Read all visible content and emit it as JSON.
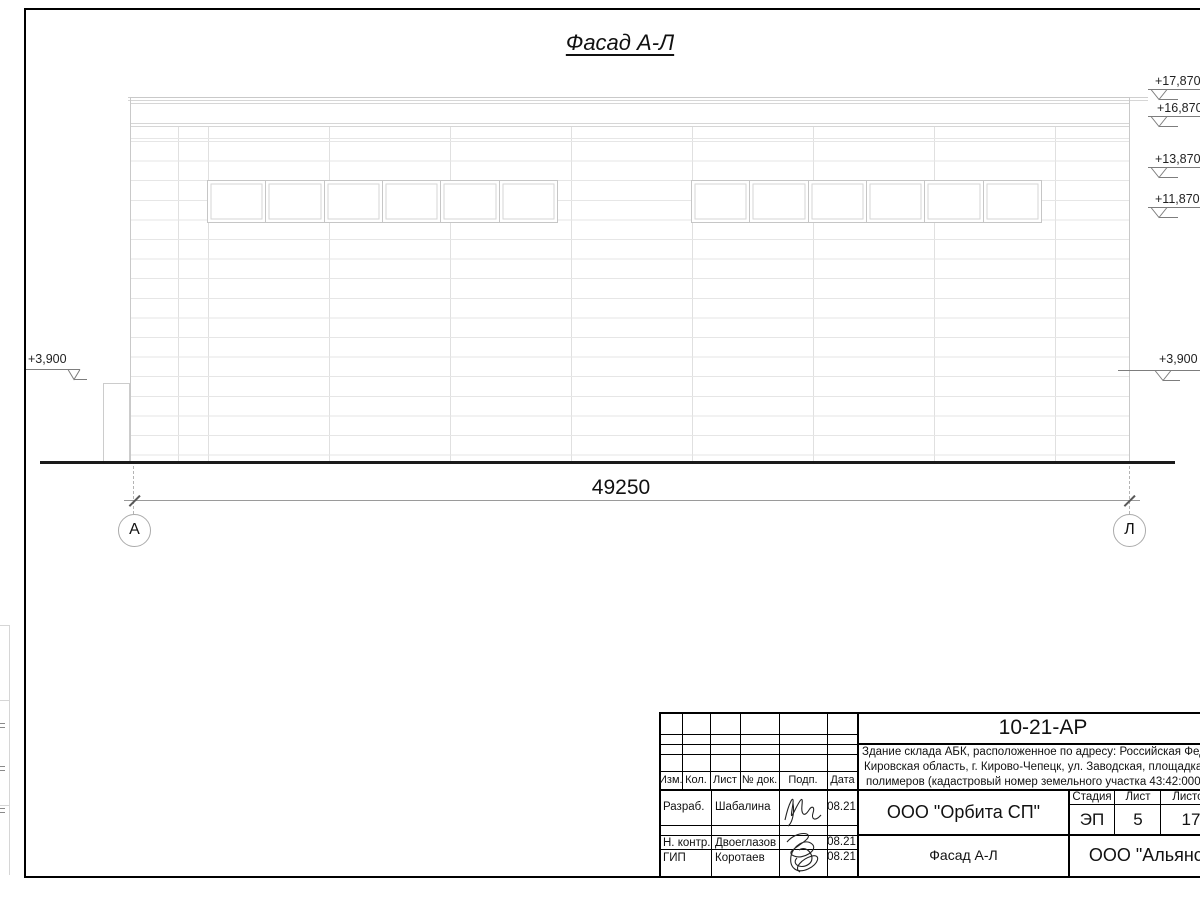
{
  "sheet": {
    "title": "Фасад А-Л",
    "dimension_total": "49250",
    "axes": {
      "left": "А",
      "right": "Л"
    },
    "elevations": {
      "parapet_top": "+17,870",
      "parapet_bottom": "+16,870",
      "windows_top": "+13,870",
      "windows_bottom": "+11,870",
      "annex_left": "+3,900",
      "annex_right": "+3,900"
    },
    "colors": {
      "ground_line": "#1a1a1a",
      "panel_line": "#e6e6e6",
      "window_frame": "#c6c6c6"
    }
  },
  "title_block": {
    "doc_number": "10-21-АР",
    "project_description": {
      "line1": "Здание склада АБК, расположенное по адресу: Российская Федерация,",
      "line2": "Кировская область, г. Кирово-Чепецк, ул. Заводская, площадка завода",
      "line3": "полимеров (кадастровый номер земельного участка 43:42:000022:43)"
    },
    "columns": {
      "izm": "Изм.",
      "kol": "Кол.",
      "list": "Лист",
      "doc_no": "№ док.",
      "podp": "Подп.",
      "data": "Дата"
    },
    "signatures": [
      {
        "role": "Разраб.",
        "name": "Шабалина",
        "date": "08.21"
      },
      {
        "role": "Н. контр.",
        "name": "Двоеглазов",
        "date": "08.21"
      },
      {
        "role": "ГИП",
        "name": "Коротаев",
        "date": "08.21"
      }
    ],
    "client_org": "ООО \"Орбита СП\"",
    "stage": {
      "label": "Стадия",
      "value": "ЭП"
    },
    "sheet_no": {
      "label": "Лист",
      "value": "5"
    },
    "sheets_total": {
      "label": "Листов",
      "value": "17"
    },
    "view_name": "Фасад А-Л",
    "design_org": "ООО \"Альянс\""
  }
}
